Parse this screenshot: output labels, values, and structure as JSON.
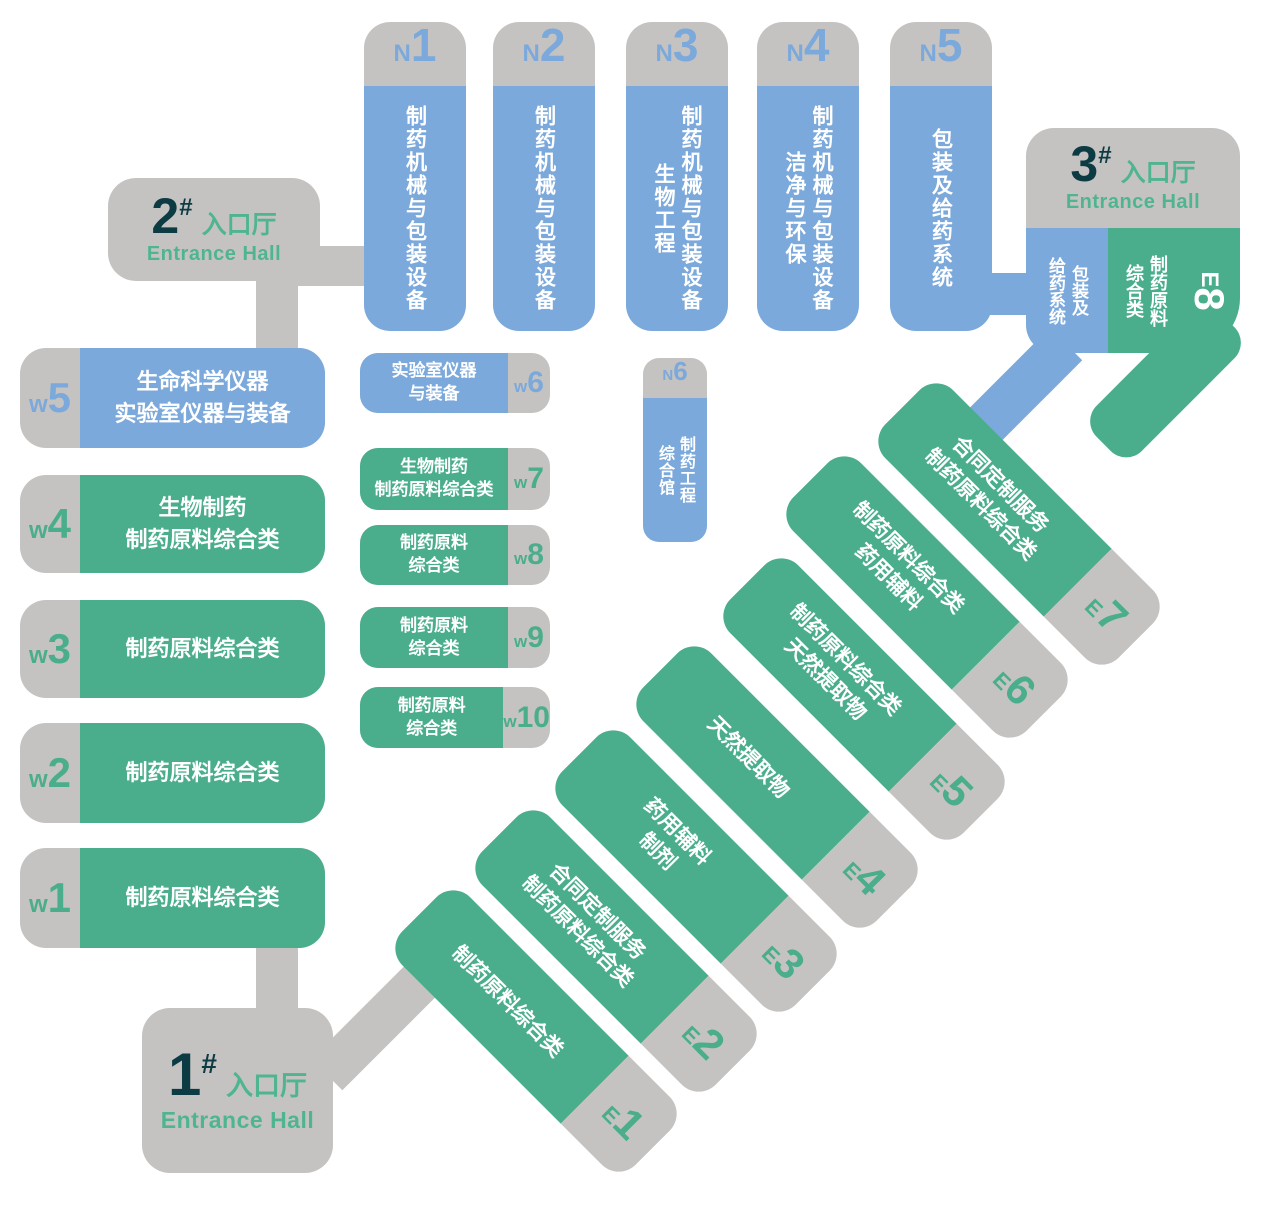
{
  "colors": {
    "hall_blue": "#7ca9db",
    "hall_green": "#4aae8c",
    "hall_gray": "#c5c3c1",
    "number_dark": "#0d3b44",
    "entrance_green": "#4fb591",
    "text_white": "#ffffff"
  },
  "entrances": [
    {
      "number": "1",
      "hash": "#",
      "zh": "入口厅",
      "en": "Entrance Hall"
    },
    {
      "number": "2",
      "hash": "#",
      "zh": "入口厅",
      "en": "Entrance Hall"
    },
    {
      "number": "3",
      "hash": "#",
      "zh": "入口厅",
      "en": "Entrance Hall"
    }
  ],
  "north_halls": [
    {
      "letter": "N",
      "number": "1",
      "label": "制药机械与包装设备"
    },
    {
      "letter": "N",
      "number": "2",
      "label": "制药机械与包装设备"
    },
    {
      "letter": "N",
      "number": "3",
      "label": "制药机械与包装设备\n生物工程"
    },
    {
      "letter": "N",
      "number": "4",
      "label": "制药机械与包装设备\n洁净与环保"
    },
    {
      "letter": "N",
      "number": "5",
      "label": "包装及给药系统"
    },
    {
      "letter": "N",
      "number": "6",
      "label": "制药工程\n综合馆"
    }
  ],
  "west_halls": [
    {
      "letter": "w",
      "number": "5",
      "label": "生命科学仪器\n实验室仪器与装备"
    },
    {
      "letter": "w",
      "number": "4",
      "label": "生物制药\n制药原料综合类"
    },
    {
      "letter": "w",
      "number": "3",
      "label": "制药原料综合类"
    },
    {
      "letter": "w",
      "number": "2",
      "label": "制药原料综合类"
    },
    {
      "letter": "w",
      "number": "1",
      "label": "制药原料综合类"
    },
    {
      "letter": "w",
      "number": "6",
      "label": "实验室仪器\n与装备"
    },
    {
      "letter": "w",
      "number": "7",
      "label": "生物制药\n制药原料综合类"
    },
    {
      "letter": "w",
      "number": "8",
      "label": "制药原料\n综合类"
    },
    {
      "letter": "w",
      "number": "9",
      "label": "制药原料\n综合类"
    },
    {
      "letter": "w",
      "number": "10",
      "label": "制药原料\n综合类"
    }
  ],
  "east_halls": [
    {
      "letter": "E",
      "number": "1",
      "label": "制药原料综合类"
    },
    {
      "letter": "E",
      "number": "2",
      "label": "合同定制服务\n制药原料综合类"
    },
    {
      "letter": "E",
      "number": "3",
      "label": "药用辅料\n制剂"
    },
    {
      "letter": "E",
      "number": "4",
      "label": "天然提取物"
    },
    {
      "letter": "E",
      "number": "5",
      "label": "制药原料综合类\n天然提取物"
    },
    {
      "letter": "E",
      "number": "6",
      "label": "制药原料综合类\n药用辅料"
    },
    {
      "letter": "E",
      "number": "7",
      "label": "合同定制服务\n制药原料综合类"
    },
    {
      "letter": "E",
      "number": "8",
      "label": "制药原料\n综合类",
      "blue_label": "包装及\n给药系统"
    }
  ]
}
